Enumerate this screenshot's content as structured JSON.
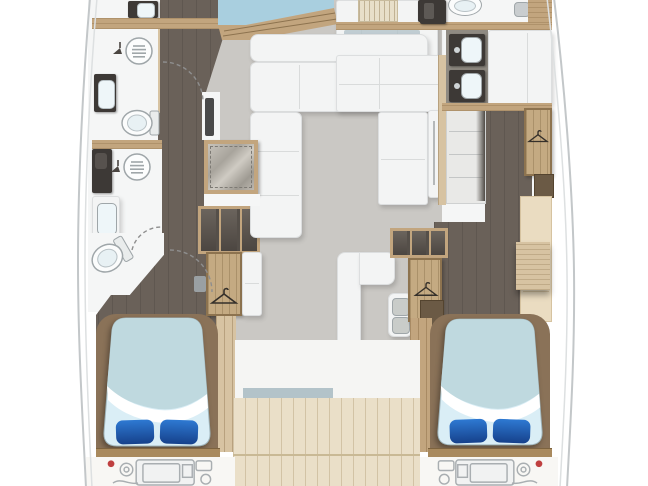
{
  "meta": {
    "title": "Catamaran yacht interior floor plan (top-down deck layout)",
    "view": "overhead-floorplan",
    "no_visible_text": true
  },
  "colors": {
    "page_bg": "#ffffff",
    "hull_line": "#c3c7c9",
    "hull_line_inner": "#dde0e1",
    "salon_floor": "#cac8c4",
    "dark_floor": "#6a6159",
    "bathroom_white": "#f5f6f6",
    "furniture_white": "#f3f4f4",
    "furniture_edge": "#dcdedf",
    "wood_light": "#d7c3a2",
    "wood_mid": "#c2a57e",
    "wood_dark": "#8a7258",
    "wood_deck": "#eadfc8",
    "closet_wood": "#c4aa82",
    "bed_foot": "#bfd9df",
    "bed_sheet": "#daeef6",
    "pillow_blue": "#2e79d2",
    "pillow_blue_dark": "#16418b",
    "window_blue": "#a9cfdf",
    "glass_blue": "#b3c3c9",
    "fixture_dark": "#3d3936",
    "basin_white": "#eef6f9",
    "steel_gray": "#9fa6a9",
    "vanity_gray": "#8f8a82",
    "cream_desk": "#eadcc1",
    "stair_dark": "#554f49",
    "engine_line": "#a9aeb1",
    "engine_red": "#bf4040",
    "arc_gray": "#8e8e8e"
  },
  "structure": {
    "left_hull": {
      "fixtures": [
        "counter-with-basin",
        "shower-drain",
        "shower-head",
        "vanity-sink",
        "toilet",
        "lower-shower-drain",
        "storage-cabinet",
        "second-vanity-sink",
        "second-toilet",
        "staircase-down",
        "wardrobe-with-hanger",
        "double-berth-bed",
        "two-pillows",
        "engine-bay"
      ]
    },
    "salon_center": {
      "fixtures": [
        "bow-window",
        "window-wood-trim",
        "wardrobe-with-hanger",
        "l-shaped-sofa",
        "tv-panel",
        "skylight-hatch-table",
        "galley-counters",
        "cooktop-unit",
        "c-shaped-settee",
        "double-basin-unit",
        "staircase-down",
        "wardrobe-with-hanger",
        "cockpit-teak-deck"
      ]
    },
    "right_hull": {
      "fixtures": [
        "shower-column",
        "toilet",
        "faucet",
        "wood-cabinet",
        "double-sink-vanity",
        "vanity-counter",
        "staircase-down",
        "wardrobe-with-hanger",
        "desk-cabinet",
        "double-berth-bed",
        "two-pillows",
        "engine-bay"
      ]
    },
    "icons": [
      "hanger-icon",
      "shower-drain-icon",
      "shower-head-icon",
      "door-swing-arc",
      "engine-block-icon"
    ]
  }
}
